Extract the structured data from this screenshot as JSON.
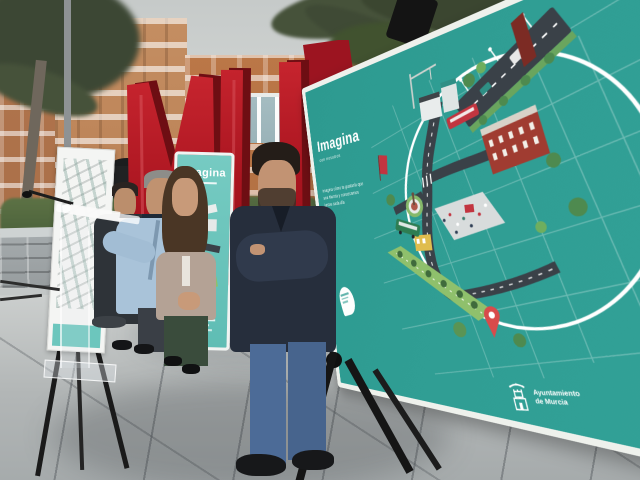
{
  "photo": {
    "board": {
      "heading": "Imagina",
      "subheading": "con nosotros",
      "tagline": [
        "imagina cómo te gustaría que",
        "sea Murcia y conozcamos",
        "juntos cada día"
      ],
      "logo": {
        "line1": "Ayuntamiento",
        "line2": "de Murcia"
      },
      "teal": "#2f9c92",
      "border": "#eef1ec"
    },
    "banner": {
      "heading": "imagina",
      "teal": "#6cc6bd"
    },
    "sculpture": {
      "letters": [
        "M",
        "U",
        "R"
      ],
      "red": "#a8141f"
    },
    "people_count": 4,
    "illustration_elements": [
      "road-icon",
      "tram-icon",
      "bus-icon",
      "brick-building-icon",
      "plaza-icon",
      "park-icon",
      "monument-icon",
      "location-pin-icon",
      "tree-icon",
      "crane-icon"
    ]
  }
}
